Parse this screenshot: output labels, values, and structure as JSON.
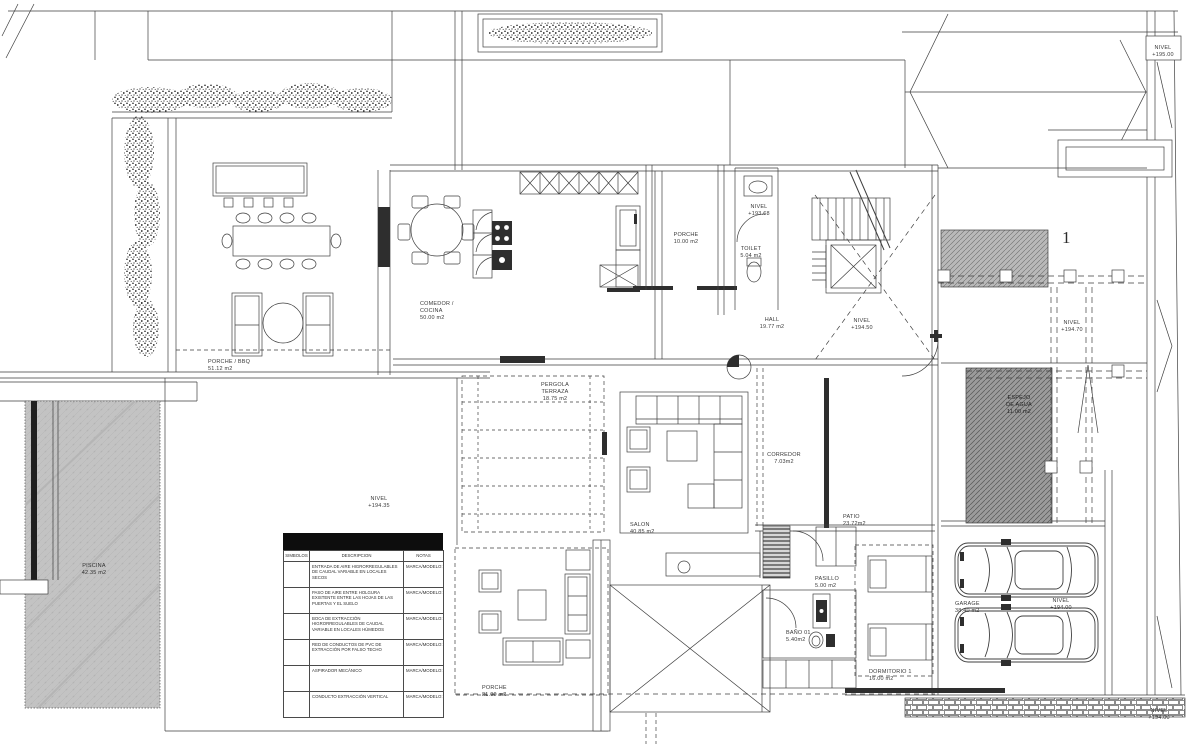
{
  "drawing": {
    "type": "floor-plan",
    "language": "es"
  },
  "colors": {
    "line": "#3f3f3f",
    "dark_fill": "#2e2e2e",
    "pool_gray": "#c3c3c3",
    "hatch_gray": "#9b9b9b",
    "legend_header": "#0d0d0d",
    "paper": "#ffffff"
  },
  "rooms": [
    {
      "name": "PORCHE / BBQ",
      "area": "51.12 m2"
    },
    {
      "name": "COMEDOR /\nCOCINA",
      "area": "50.00 m2"
    },
    {
      "name": "PORCHE",
      "area": "10.00 m2"
    },
    {
      "name": "TOILET",
      "area": "5.04 m2"
    },
    {
      "name": "HALL",
      "area": "19.77 m2"
    },
    {
      "name": "PERGOLA\nTERRAZA",
      "area": "18.75 m2"
    },
    {
      "name": "CORREDOR",
      "area": "7.03m2"
    },
    {
      "name": "SALON",
      "area": "40.85 m2"
    },
    {
      "name": "PATIO",
      "area": "23.72m2"
    },
    {
      "name": "PISCINA",
      "area": "42.35 m2"
    },
    {
      "name": "PORCHE",
      "area": "21.00 m2"
    },
    {
      "name": "PASILLO",
      "area": "5.00 m2"
    },
    {
      "name": "BAÑO 01",
      "area": "5.40m2"
    },
    {
      "name": "DORMITORIO 1",
      "area": "16.00 m2"
    },
    {
      "name": "GARAGE",
      "area": "38.40 m2"
    },
    {
      "name": "ESPEJO\nDE AGUA",
      "area": "11.00 m2"
    }
  ],
  "levels": [
    {
      "label": "NIVEL",
      "value": "+193.68"
    },
    {
      "label": "NIVEL",
      "value": "+194.50"
    },
    {
      "label": "NIVEL",
      "value": "+194.70"
    },
    {
      "label": "NIVEL",
      "value": "+195.00"
    },
    {
      "label": "NIVEL",
      "value": "+194.35"
    },
    {
      "label": "NIVEL",
      "value": "+194.00"
    },
    {
      "label": "NIVEL",
      "value": "+194.00"
    }
  ],
  "annotations": {
    "stair_number": "1"
  },
  "legend": {
    "columns": [
      "SIMBOLOS",
      "DESCRIPCION",
      "NOTAS"
    ],
    "rows": [
      {
        "descripcion": "ENTRADA DE AIRE HIGRORREGULABLES DE CAUDAL VARIABLE EN LOCALES SECOS",
        "notas": "MARCA/MODELO:"
      },
      {
        "descripcion": "PASO DE AIRE ENTRE HOLGURA EXISTENTE ENTRE LAS HOJAS DE LAS PUERTAS Y EL SUELO",
        "notas": "MARCA/MODELO:"
      },
      {
        "descripcion": "BOCA DE EXTRACCIÓN HIGRORREGULABLES DE CAUDAL VARIABLE EN LOCALES HÚMEDOS",
        "notas": "MARCA/MODELO:"
      },
      {
        "descripcion": "RED DE CONDUCTOS DE PVC DE EXTRACCIÓN POR FALSO TECHO",
        "notas": "MARCA/MODELO:"
      },
      {
        "descripcion": "ASPIRADOR MECÁNICO",
        "notas": "MARCA/MODELO:"
      },
      {
        "descripcion": "CONDUCTO EXTRACCIÓN VERTICAL",
        "notas": "MARCA/MODELO:"
      }
    ]
  }
}
